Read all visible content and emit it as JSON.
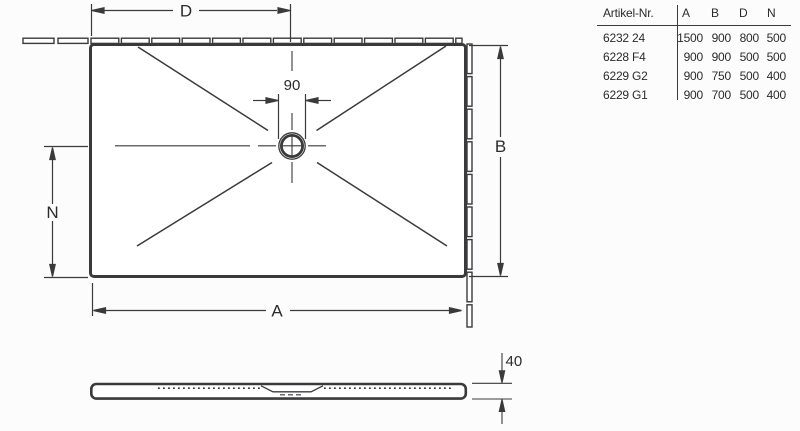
{
  "drawing": {
    "labels": {
      "d": "D",
      "b": "B",
      "n": "N",
      "a": "A",
      "drain_diameter": "90",
      "tray_height": "40"
    }
  },
  "table": {
    "header": {
      "article": "Artikel-Nr.",
      "a": "A",
      "b": "B",
      "d": "D",
      "n": "N"
    },
    "rows": [
      {
        "article": "6232 24",
        "a": "1500",
        "b": "900",
        "d": "800",
        "n": "500"
      },
      {
        "article": "6228 F4",
        "a": "900",
        "b": "900",
        "d": "500",
        "n": "500"
      },
      {
        "article": "6229 G2",
        "a": "900",
        "b": "750",
        "d": "500",
        "n": "400"
      },
      {
        "article": "6229 G1",
        "a": "900",
        "b": "700",
        "d": "500",
        "n": "400"
      }
    ]
  },
  "colors": {
    "line": "#3a3a3c",
    "text": "#2b2b2d",
    "background": "#fcfcfc"
  }
}
